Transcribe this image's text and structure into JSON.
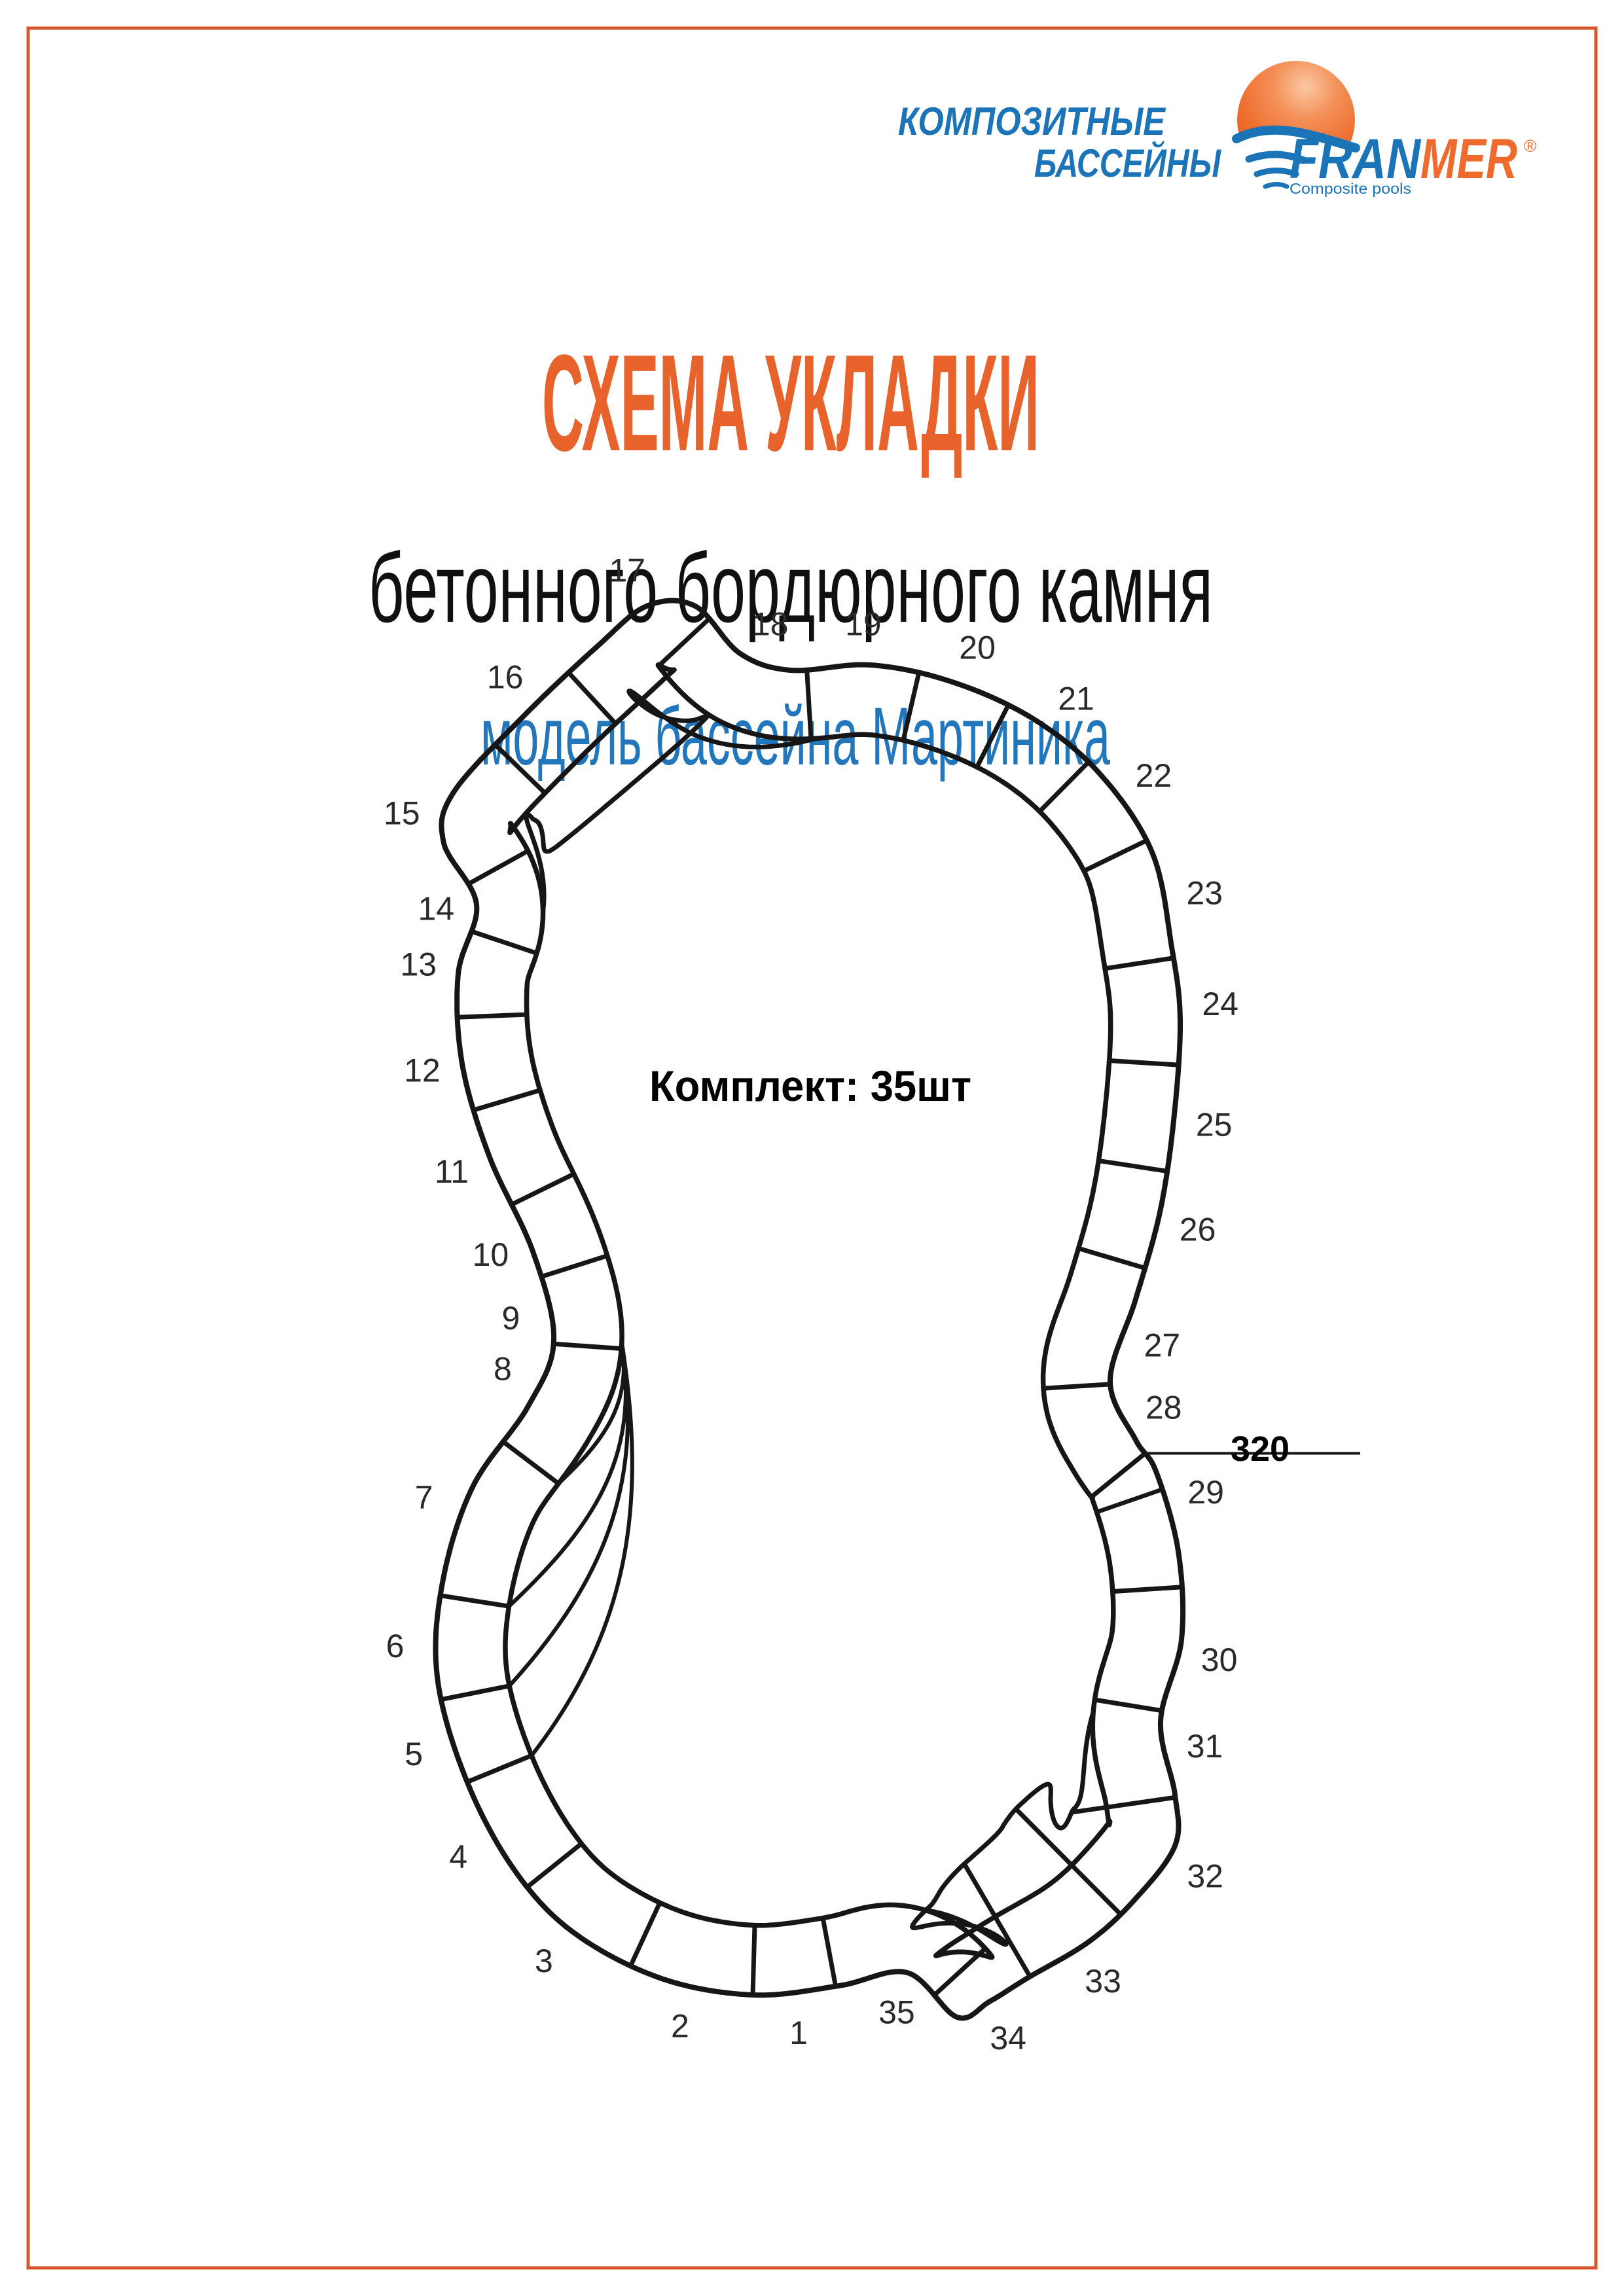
{
  "page": {
    "background": "#ffffff",
    "border_color": "#D4582B"
  },
  "logo": {
    "tagline_line1": "КОМПОЗИТНЫЕ",
    "tagline_line2": "БАССЕЙНЫ",
    "brand_part_blue": "FRAN",
    "brand_part_orange": "MER",
    "registered_mark": "®",
    "subtitle": "Composite pools",
    "blue": "#1B74B8",
    "orange": "#EE6B2D"
  },
  "titles": {
    "main": "СХЕМА УКЛАДКИ",
    "main_color": "#E8622B",
    "subtitle": "бетонного бордюрного камня",
    "subtitle_color": "#101010",
    "model": "модель бассейна Мартиника",
    "model_color": "#2176BC"
  },
  "diagram": {
    "kit_label": "Комплект: 35шт",
    "dimension_label": "320",
    "stone_count": 35,
    "stone_numbers": [
      "1",
      "2",
      "3",
      "4",
      "5",
      "6",
      "7",
      "8",
      "9",
      "10",
      "11",
      "12",
      "13",
      "14",
      "15",
      "16",
      "17",
      "18",
      "19",
      "20",
      "21",
      "22",
      "23",
      "24",
      "25",
      "26",
      "27",
      "28",
      "29",
      "30",
      "31",
      "32",
      "33",
      "34",
      "35"
    ],
    "line_color": "#161616",
    "number_color": "#2a2a2a"
  }
}
